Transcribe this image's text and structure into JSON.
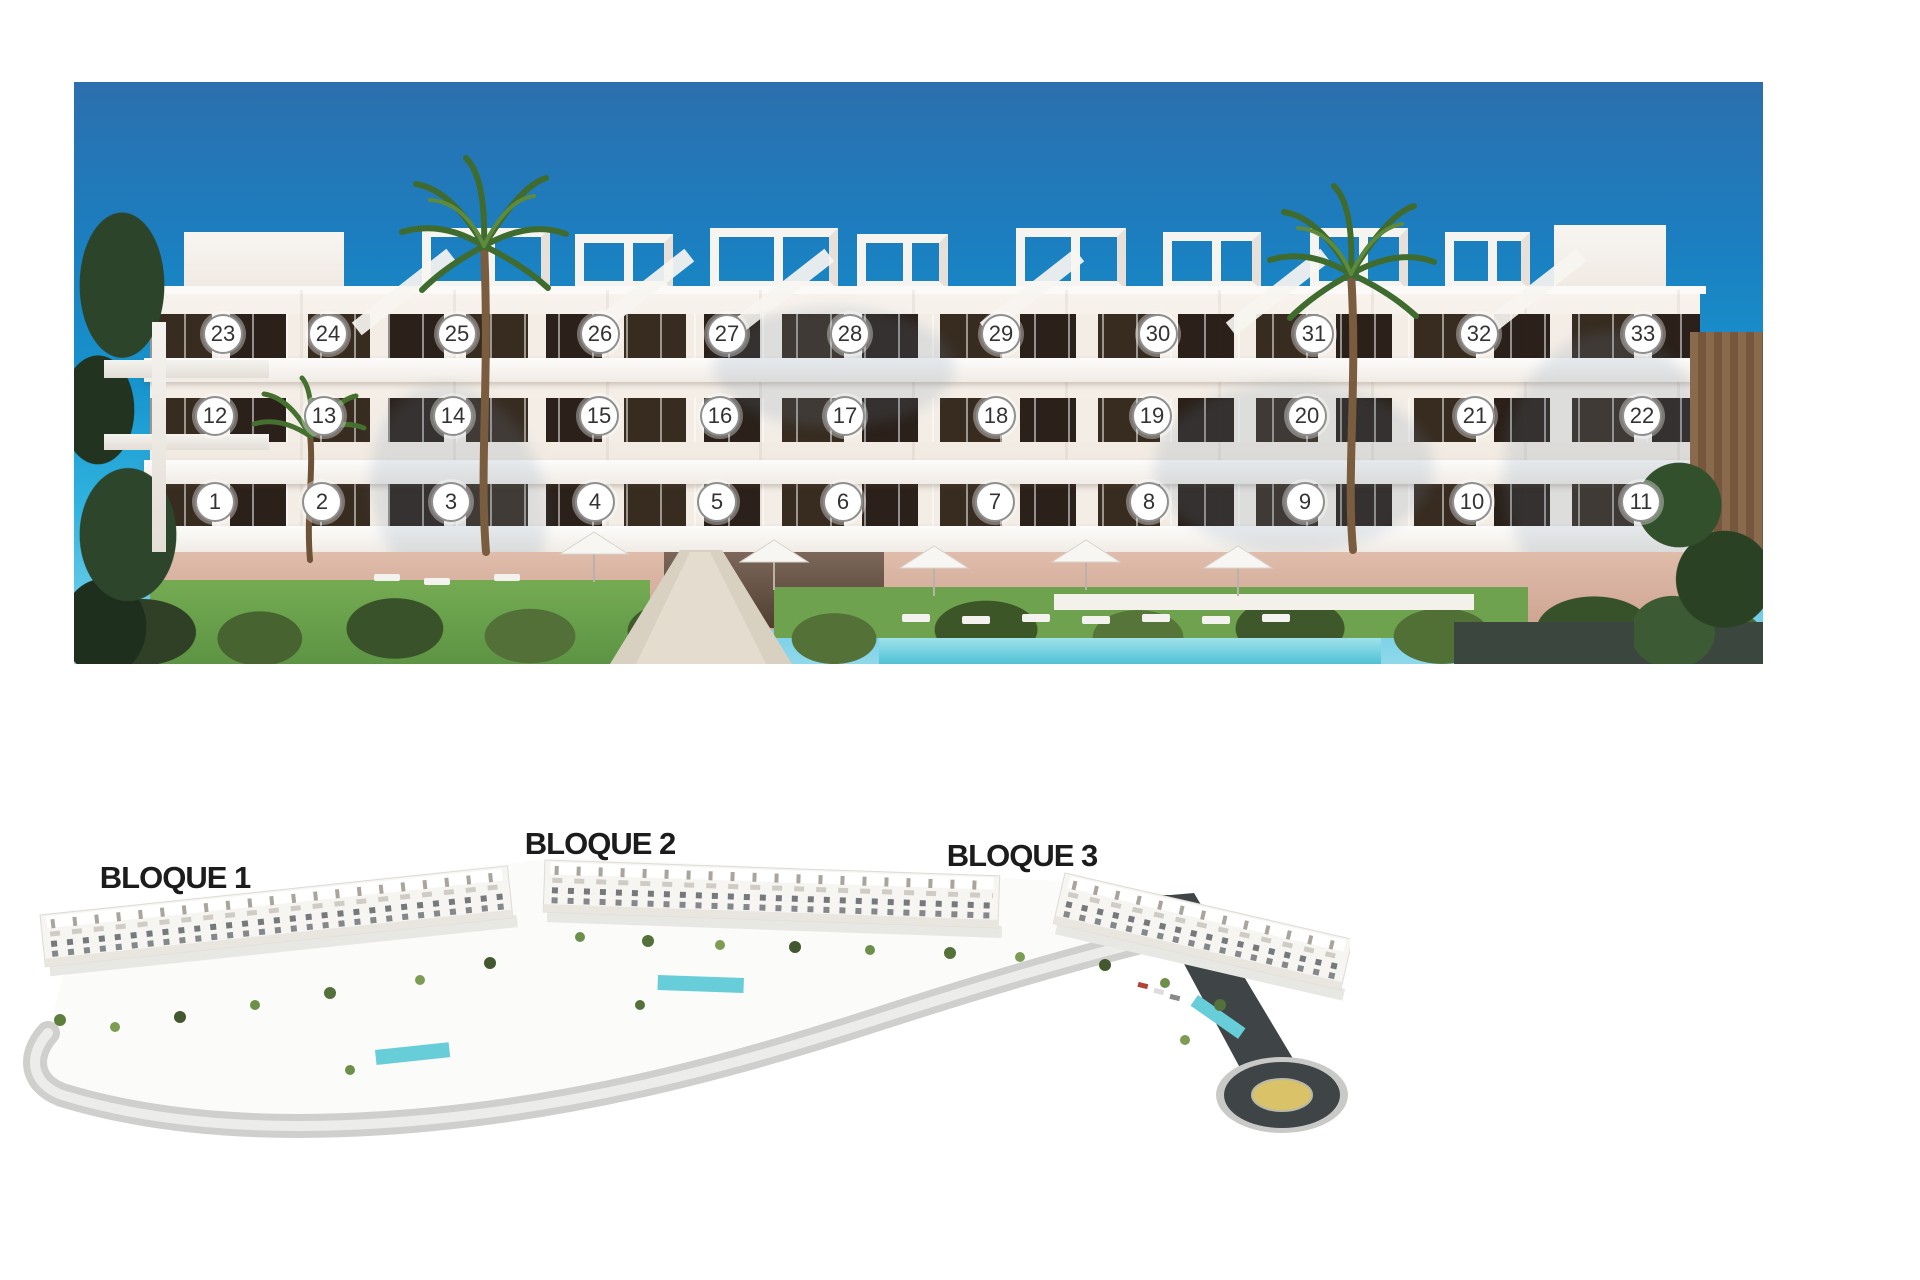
{
  "photo": {
    "badge_style": {
      "fill": "#ffffff",
      "border": "#8f8f8f",
      "text": "#333333"
    },
    "units": [
      {
        "n": "1",
        "x": 141,
        "y": 420
      },
      {
        "n": "2",
        "x": 248,
        "y": 420
      },
      {
        "n": "3",
        "x": 377,
        "y": 420
      },
      {
        "n": "4",
        "x": 521,
        "y": 420
      },
      {
        "n": "5",
        "x": 643,
        "y": 420
      },
      {
        "n": "6",
        "x": 769,
        "y": 420
      },
      {
        "n": "7",
        "x": 921,
        "y": 420
      },
      {
        "n": "8",
        "x": 1075,
        "y": 420
      },
      {
        "n": "9",
        "x": 1231,
        "y": 420
      },
      {
        "n": "10",
        "x": 1398,
        "y": 420
      },
      {
        "n": "11",
        "x": 1567,
        "y": 420
      },
      {
        "n": "12",
        "x": 141,
        "y": 334
      },
      {
        "n": "13",
        "x": 250,
        "y": 334
      },
      {
        "n": "14",
        "x": 379,
        "y": 334
      },
      {
        "n": "15",
        "x": 525,
        "y": 334
      },
      {
        "n": "16",
        "x": 646,
        "y": 334
      },
      {
        "n": "17",
        "x": 771,
        "y": 334
      },
      {
        "n": "18",
        "x": 922,
        "y": 334
      },
      {
        "n": "19",
        "x": 1078,
        "y": 334
      },
      {
        "n": "20",
        "x": 1233,
        "y": 334
      },
      {
        "n": "21",
        "x": 1401,
        "y": 334
      },
      {
        "n": "22",
        "x": 1568,
        "y": 334
      },
      {
        "n": "23",
        "x": 149,
        "y": 252
      },
      {
        "n": "24",
        "x": 254,
        "y": 252
      },
      {
        "n": "25",
        "x": 383,
        "y": 252
      },
      {
        "n": "26",
        "x": 526,
        "y": 252
      },
      {
        "n": "27",
        "x": 653,
        "y": 252
      },
      {
        "n": "28",
        "x": 776,
        "y": 252
      },
      {
        "n": "29",
        "x": 927,
        "y": 252
      },
      {
        "n": "30",
        "x": 1084,
        "y": 252
      },
      {
        "n": "31",
        "x": 1240,
        "y": 252
      },
      {
        "n": "32",
        "x": 1405,
        "y": 252
      },
      {
        "n": "33",
        "x": 1569,
        "y": 252
      }
    ]
  },
  "site_plan": {
    "labels": [
      {
        "text": "BLOQUE 1"
      },
      {
        "text": "BLOQUE 2"
      },
      {
        "text": "BLOQUE 3"
      }
    ]
  },
  "colors": {
    "sky_top": "#2c6fae",
    "sky_mid": "#1794cd",
    "sky_low": "#31b5e0",
    "sky_horizon": "#8fd8ea",
    "pool": "#4fc2d4",
    "lawn": "#6ea24e",
    "stone": "#d9b2a2",
    "dark_band": "#3a463e",
    "asphalt": "#3f4547",
    "roundabout_center": "#d9c267",
    "label_color": "#1c1c1c"
  }
}
